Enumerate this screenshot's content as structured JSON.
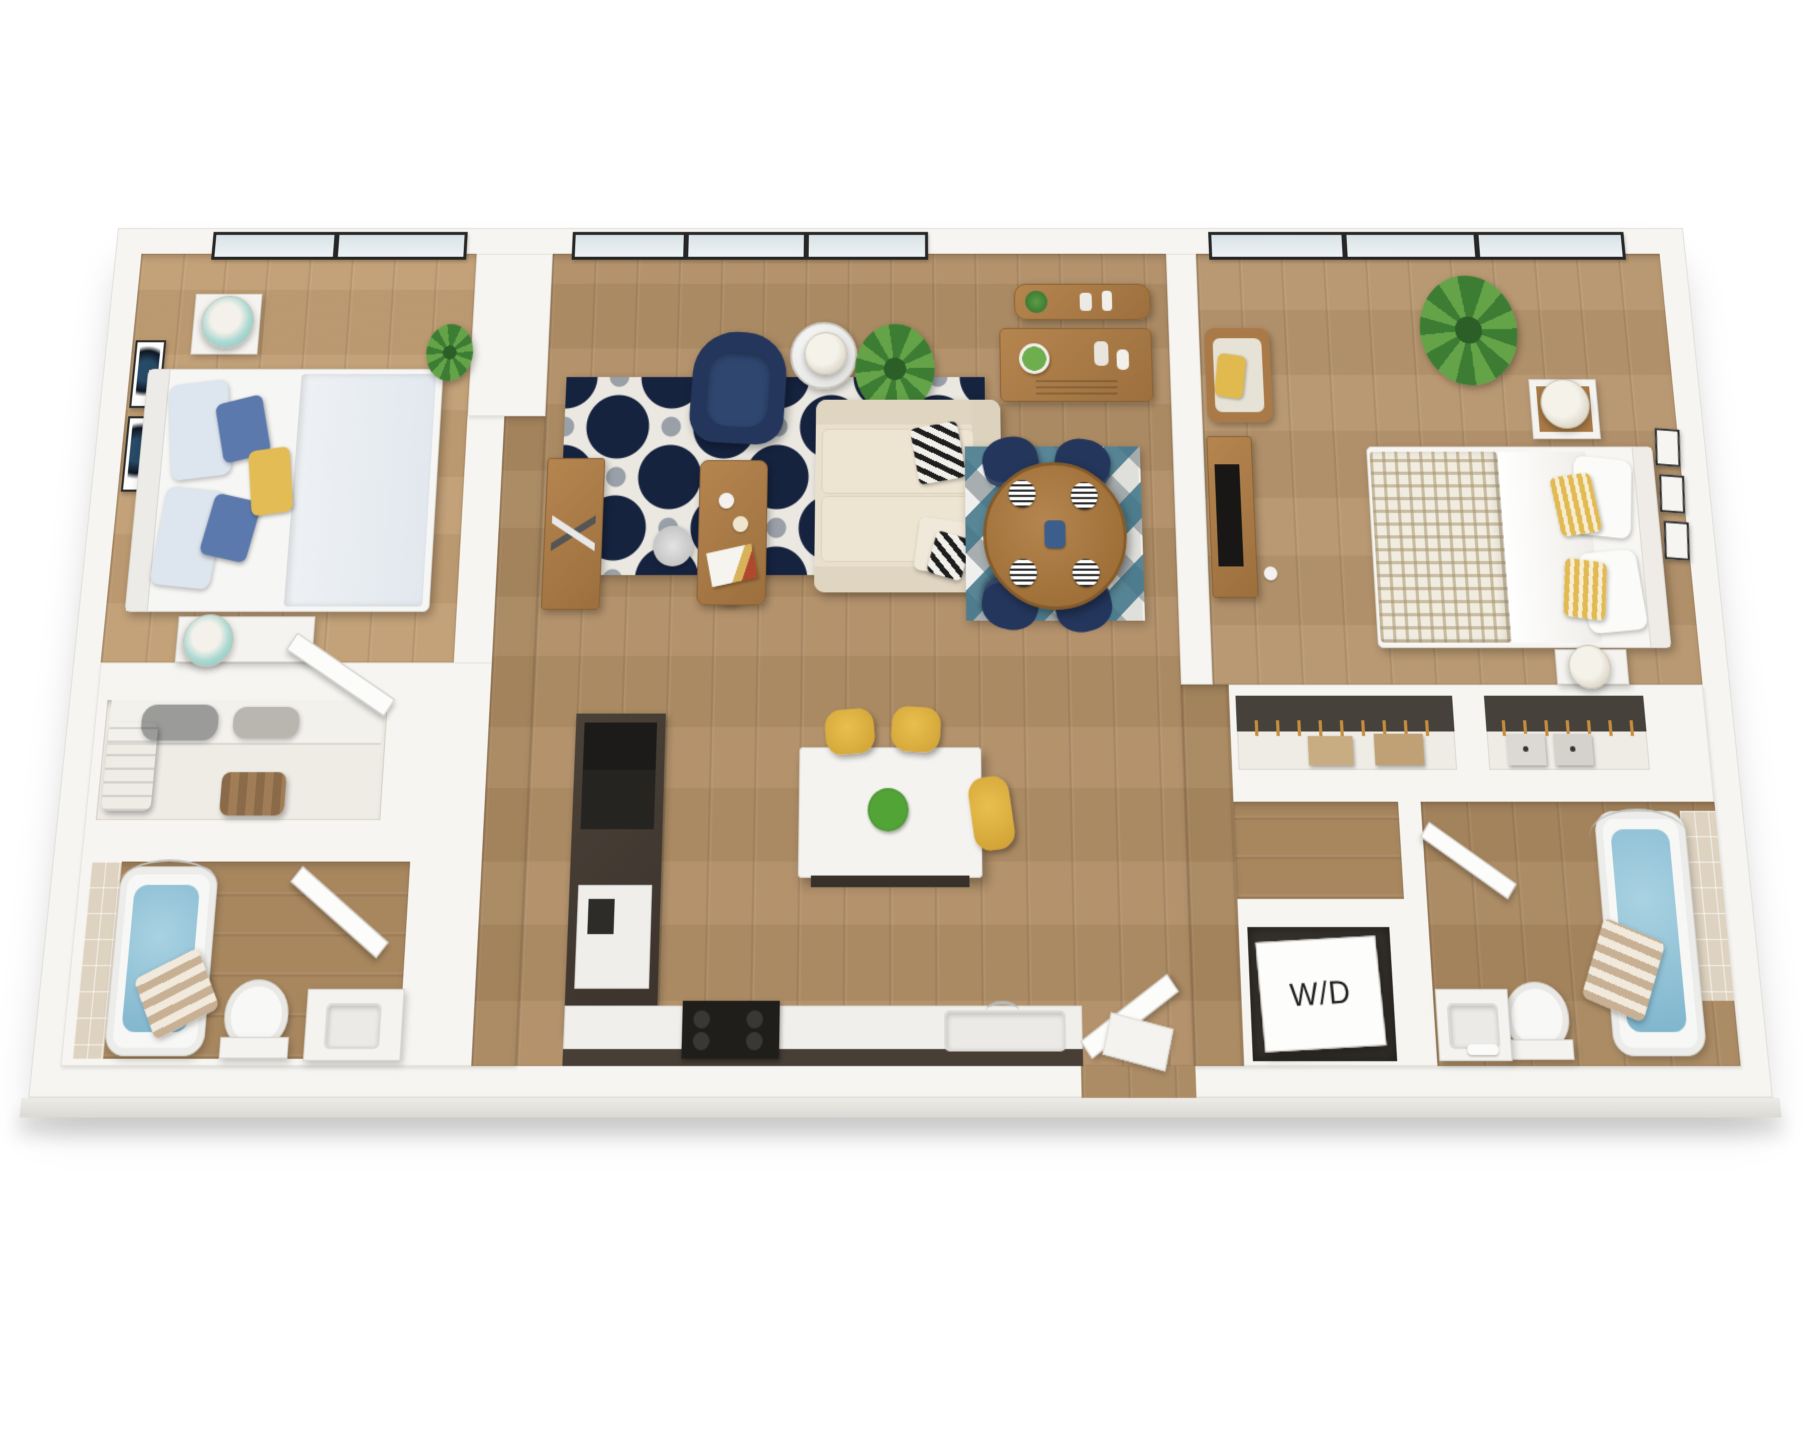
{
  "floorplan": {
    "description": "3D top-down rendering of a two-bedroom two-bathroom apartment floor plan with open living, dining and kitchen area, walk-in closet, two reach-in closets and in-unit laundry",
    "labels": {
      "washer_dryer": "W/D"
    },
    "rooms": [
      "bedroom-1",
      "walk-in-closet",
      "bathroom-1",
      "living-room",
      "dining-area",
      "kitchen",
      "entry",
      "hallway",
      "bedroom-2",
      "closet-a",
      "closet-b",
      "laundry-closet",
      "bathroom-2"
    ],
    "palette": {
      "wall_white": "#f6f5f1",
      "floor_light": "#c19e74",
      "floor_mid": "#b08e66",
      "floor_dark": "#a8875f",
      "cabinet_espresso": "#3b332c",
      "navy": "#24365c",
      "rug_navy": "#16233f",
      "rug_teal": "#3e7488",
      "sofa_cream": "#e9dfcd",
      "accent_yellow": "#dfb04a",
      "water_blue": "#92c4da",
      "wood_furniture": "#a97b49",
      "plant_green": "#4d8f3e"
    }
  }
}
